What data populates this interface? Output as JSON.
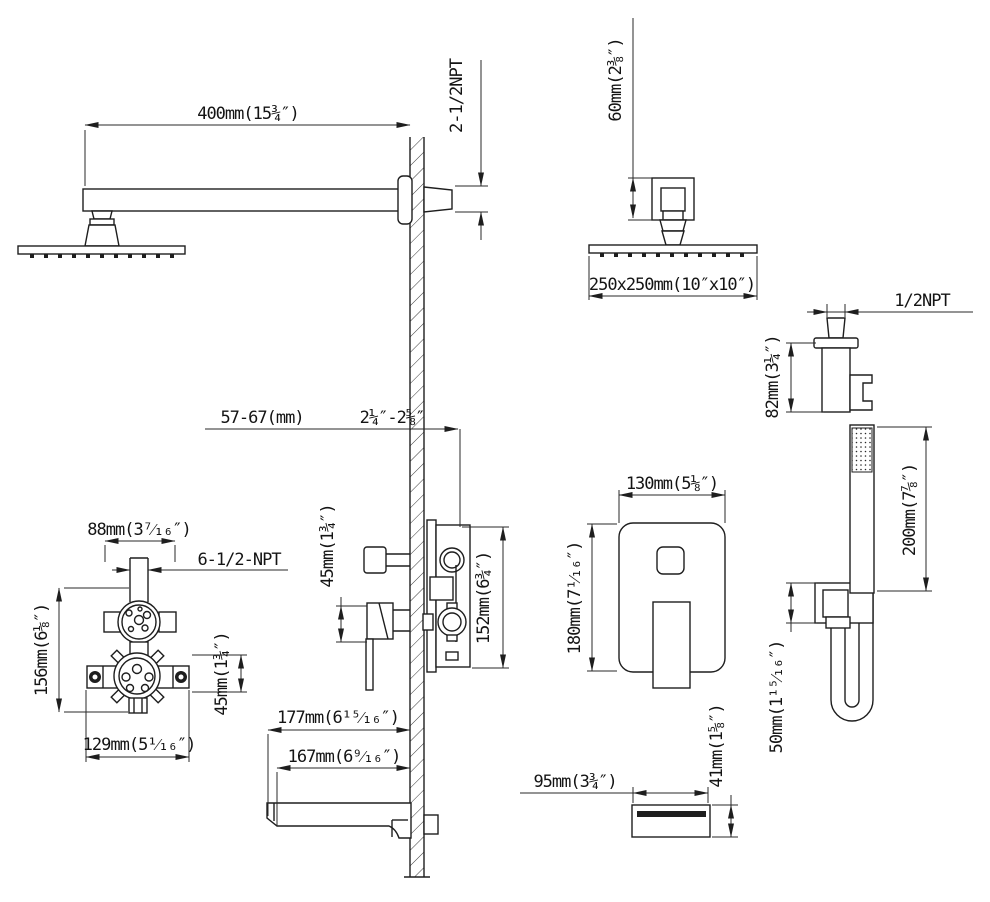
{
  "drawing": {
    "shower_arm": {
      "length": "400mm(15¾″)",
      "wall_thread": "2-1/2NPT"
    },
    "shower_head": {
      "mount_height": "60mm(2⅜″)",
      "size": "250x250mm(10″x10″)"
    },
    "hand_shower_holder": {
      "thread": "1/2NPT",
      "height": "82mm(3¼″)"
    },
    "valve_side_view": {
      "rough_in_depth_mm": "57-67(mm)",
      "rough_in_depth_in": "2¼″-2⅝″",
      "port_offset": "45mm(1¾″)",
      "body_height": "152mm(6¾″)"
    },
    "valve_front_view": {
      "thread": "6-1/2-NPT",
      "top_width": "88mm(3⁷⁄₁₆″)",
      "height": "156mm(6⅛″)",
      "port_offset": "45mm(1¾″)",
      "bottom_width": "129mm(5¹⁄₁₆″)"
    },
    "trim_plate": {
      "width": "130mm(5⅛″)",
      "height": "180mm(7¹⁄₁₆″)"
    },
    "hand_shower": {
      "length": "200mm(7⅞″)",
      "outlet_height": "50mm(1¹⁵⁄₁₆″)"
    },
    "tub_spout": {
      "length_overall": "177mm(6¹⁵⁄₁₆″)",
      "length_body": "167mm(6⁹⁄₁₆″)",
      "width": "95mm(3¾″)",
      "height": "41mm(1⅝″)"
    }
  }
}
